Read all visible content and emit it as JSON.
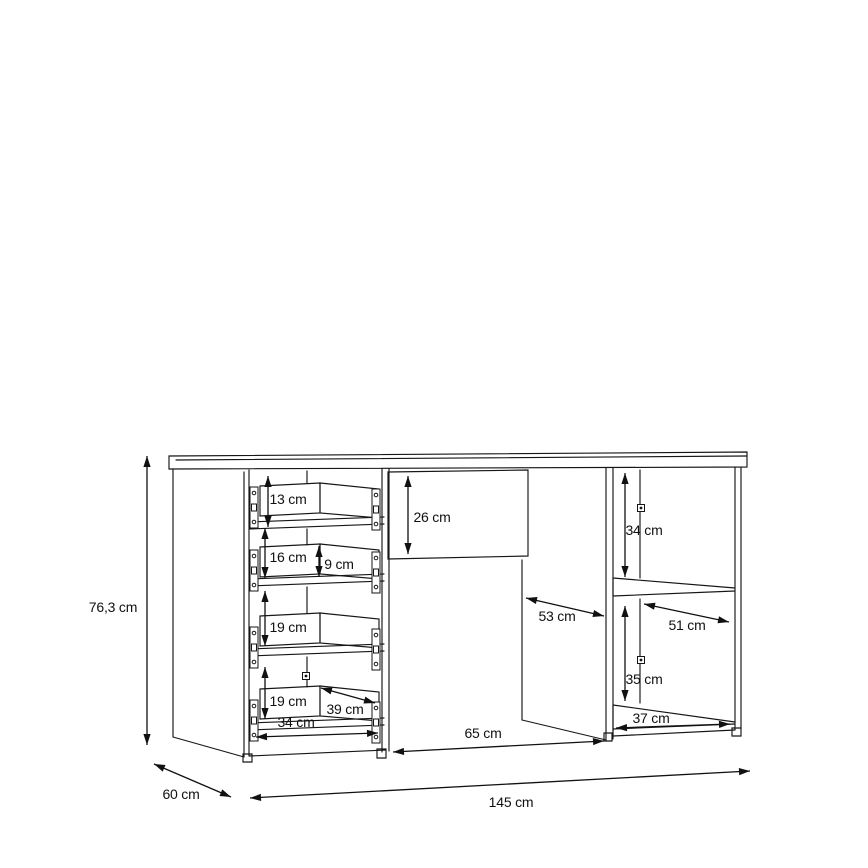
{
  "diagram": {
    "kind": "furniture-dimension-drawing",
    "unit": "cm",
    "overall": {
      "width_label": "145 cm",
      "depth_label": "60 cm",
      "height_label": "76,3 cm"
    },
    "measurements": [
      {
        "id": "overall-height",
        "label": "76,3 cm",
        "text_x": 113,
        "text_y": 612,
        "arrow": {
          "x1": 147,
          "y1": 456,
          "x2": 147,
          "y2": 745
        }
      },
      {
        "id": "overall-depth",
        "label": "60 cm",
        "text_x": 181,
        "text_y": 799,
        "arrow": {
          "x1": 154,
          "y1": 764,
          "x2": 231,
          "y2": 797
        }
      },
      {
        "id": "overall-width",
        "label": "145 cm",
        "text_x": 511,
        "text_y": 807,
        "arrow": {
          "x1": 250,
          "y1": 798,
          "x2": 750,
          "y2": 771
        }
      },
      {
        "id": "drawer-top-gap-13",
        "label": "13 cm",
        "text_x": 288,
        "text_y": 504,
        "arrow": {
          "x1": 268,
          "y1": 476,
          "x2": 268,
          "y2": 527
        }
      },
      {
        "id": "drawer-height-16",
        "label": "16 cm",
        "text_x": 288,
        "text_y": 562,
        "arrow": {
          "x1": 265,
          "y1": 528,
          "x2": 265,
          "y2": 578
        }
      },
      {
        "id": "drawer-side-9",
        "label": "9 cm",
        "text_x": 339,
        "text_y": 569,
        "arrow": {
          "x1": 319,
          "y1": 546,
          "x2": 319,
          "y2": 577
        }
      },
      {
        "id": "drawer-height-19a",
        "label": "19 cm",
        "text_x": 288,
        "text_y": 632,
        "arrow": {
          "x1": 265,
          "y1": 591,
          "x2": 265,
          "y2": 646
        }
      },
      {
        "id": "drawer-height-19b",
        "label": "19 cm",
        "text_x": 288,
        "text_y": 706,
        "arrow": {
          "x1": 265,
          "y1": 667,
          "x2": 265,
          "y2": 719
        }
      },
      {
        "id": "drawer-depth-39",
        "label": "39 cm",
        "text_x": 345,
        "text_y": 714,
        "arrow": {
          "x1": 321,
          "y1": 688,
          "x2": 375,
          "y2": 703
        }
      },
      {
        "id": "drawer-width-34",
        "label": "34 cm",
        "text_x": 296,
        "text_y": 727,
        "arrow": {
          "x1": 256,
          "y1": 737,
          "x2": 378,
          "y2": 733
        }
      },
      {
        "id": "niche-height-26",
        "label": "26 cm",
        "text_x": 432,
        "text_y": 522,
        "arrow": {
          "x1": 408,
          "y1": 476,
          "x2": 408,
          "y2": 554
        }
      },
      {
        "id": "cupboard-depth-53",
        "label": "53 cm",
        "text_x": 557,
        "text_y": 621,
        "arrow": {
          "x1": 526,
          "y1": 598,
          "x2": 604,
          "y2": 616
        }
      },
      {
        "id": "door-width-65",
        "label": "65 cm",
        "text_x": 483,
        "text_y": 738,
        "arrow": {
          "x1": 393,
          "y1": 752,
          "x2": 604,
          "y2": 741
        }
      },
      {
        "id": "shelf-top-height-34",
        "label": "34 cm",
        "text_x": 644,
        "text_y": 535,
        "arrow": {
          "x1": 625,
          "y1": 473,
          "x2": 625,
          "y2": 577
        }
      },
      {
        "id": "shelf-depth-51",
        "label": "51 cm",
        "text_x": 687,
        "text_y": 630,
        "arrow": {
          "x1": 644,
          "y1": 604,
          "x2": 729,
          "y2": 622
        }
      },
      {
        "id": "shelf-bot-height-35",
        "label": "35 cm",
        "text_x": 644,
        "text_y": 684,
        "arrow": {
          "x1": 625,
          "y1": 606,
          "x2": 625,
          "y2": 701
        }
      },
      {
        "id": "shelf-width-37",
        "label": "37 cm",
        "text_x": 651,
        "text_y": 723,
        "arrow": {
          "x1": 616,
          "y1": 728,
          "x2": 730,
          "y2": 724
        }
      }
    ],
    "hardware": {
      "runners": [
        {
          "x": 250,
          "y": 487
        },
        {
          "x": 250,
          "y": 550
        },
        {
          "x": 250,
          "y": 627
        },
        {
          "x": 250,
          "y": 700
        },
        {
          "x": 372,
          "y": 489
        },
        {
          "x": 372,
          "y": 552
        },
        {
          "x": 372,
          "y": 629
        },
        {
          "x": 372,
          "y": 702
        }
      ],
      "cam_screws": [
        {
          "x": 306,
          "y": 676
        },
        {
          "x": 641,
          "y": 508
        },
        {
          "x": 641,
          "y": 660
        }
      ]
    }
  }
}
